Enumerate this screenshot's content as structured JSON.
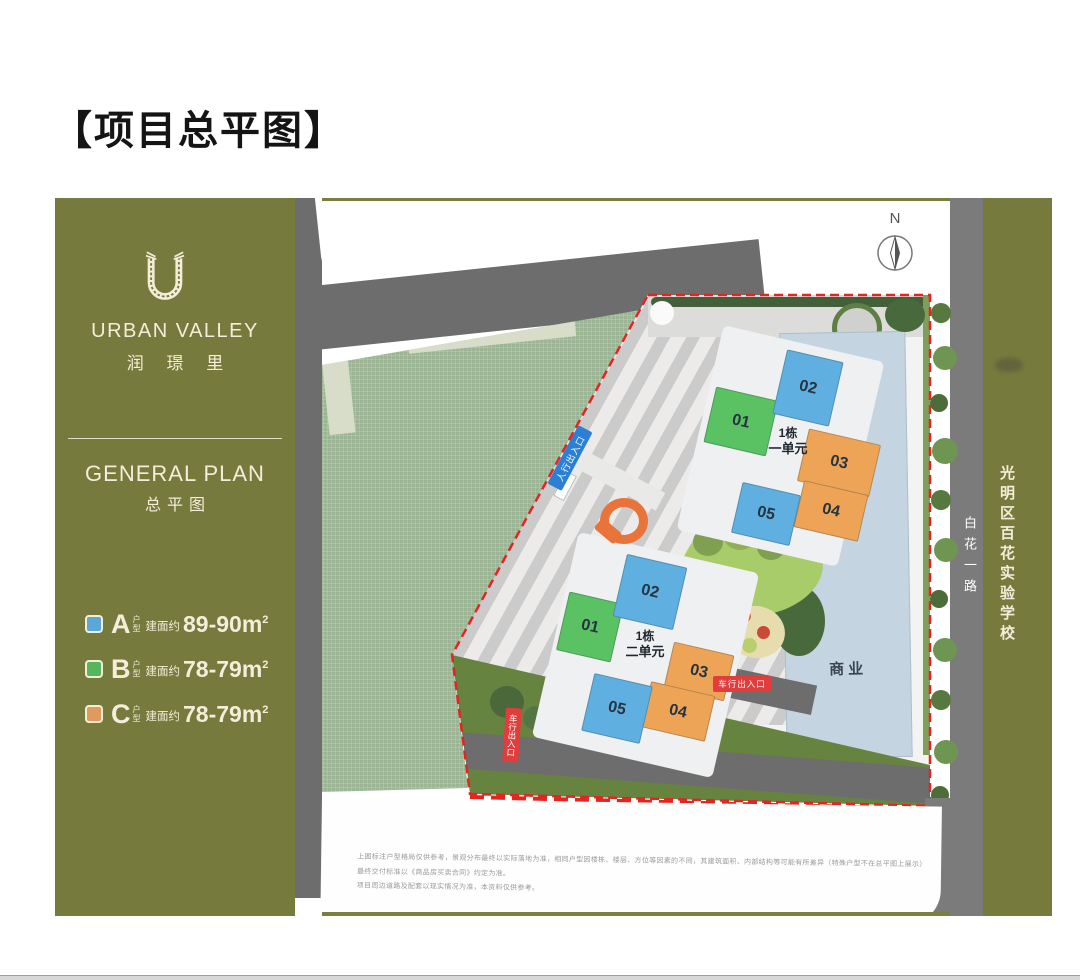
{
  "title": "【项目总平图】",
  "sidebar": {
    "logo": "U-leaf-monogram",
    "brand_en": "URBAN VALLEY",
    "brand_cn": "润 璟 里",
    "section_en": "GENERAL PLAN",
    "section_cn": "总平图",
    "legend": [
      {
        "letter": "A",
        "suffix_top": "户",
        "suffix_bottom": "型",
        "prefix": "建面约",
        "area": "89-90m",
        "sup": "2",
        "color": "#5aa8d8"
      },
      {
        "letter": "B",
        "suffix_top": "户",
        "suffix_bottom": "型",
        "prefix": "建面约",
        "area": "78-79m",
        "sup": "2",
        "color": "#57b65c"
      },
      {
        "letter": "C",
        "suffix_top": "户",
        "suffix_bottom": "型",
        "prefix": "建面约",
        "area": "78-79m",
        "sup": "2",
        "color": "#e09a5c"
      }
    ]
  },
  "plan": {
    "north": "N",
    "clusters": [
      {
        "line1": "1栋",
        "line2": "一单元",
        "buildings": [
          {
            "num": "01",
            "color": "#5ac263"
          },
          {
            "num": "02",
            "color": "#5fb0e0"
          },
          {
            "num": "03",
            "color": "#eda457"
          },
          {
            "num": "04",
            "color": "#eda457"
          },
          {
            "num": "05",
            "color": "#5fb0e0"
          }
        ]
      },
      {
        "line1": "1栋",
        "line2": "二单元",
        "buildings": [
          {
            "num": "01",
            "color": "#5ac263"
          },
          {
            "num": "02",
            "color": "#5fb0e0"
          },
          {
            "num": "03",
            "color": "#eda457"
          },
          {
            "num": "04",
            "color": "#eda457"
          },
          {
            "num": "05",
            "color": "#5fb0e0"
          }
        ]
      }
    ],
    "commercial": "商业",
    "entrance_pedestrian": "人行出入口",
    "entrance_vehicle_right": "车行出入口",
    "entrance_vehicle_bottom": "车行出入口",
    "east_road": "白花一路",
    "school": "光明区百花实验学校",
    "boundary_color": "#e52320",
    "disclaimer": [
      "上图标注户型格局仅供参考，景观分布最终以实际落地为准，相同户型因楼栋、楼层、方位等因素的不同，其建筑面积、内部结构等可能有所差异（特殊户型不在总平图上展示）最终交付标准以《商品房买卖合同》约定为准。",
      "项目周边道路及配套以现实情况为准，本资料仅供参考。"
    ]
  }
}
